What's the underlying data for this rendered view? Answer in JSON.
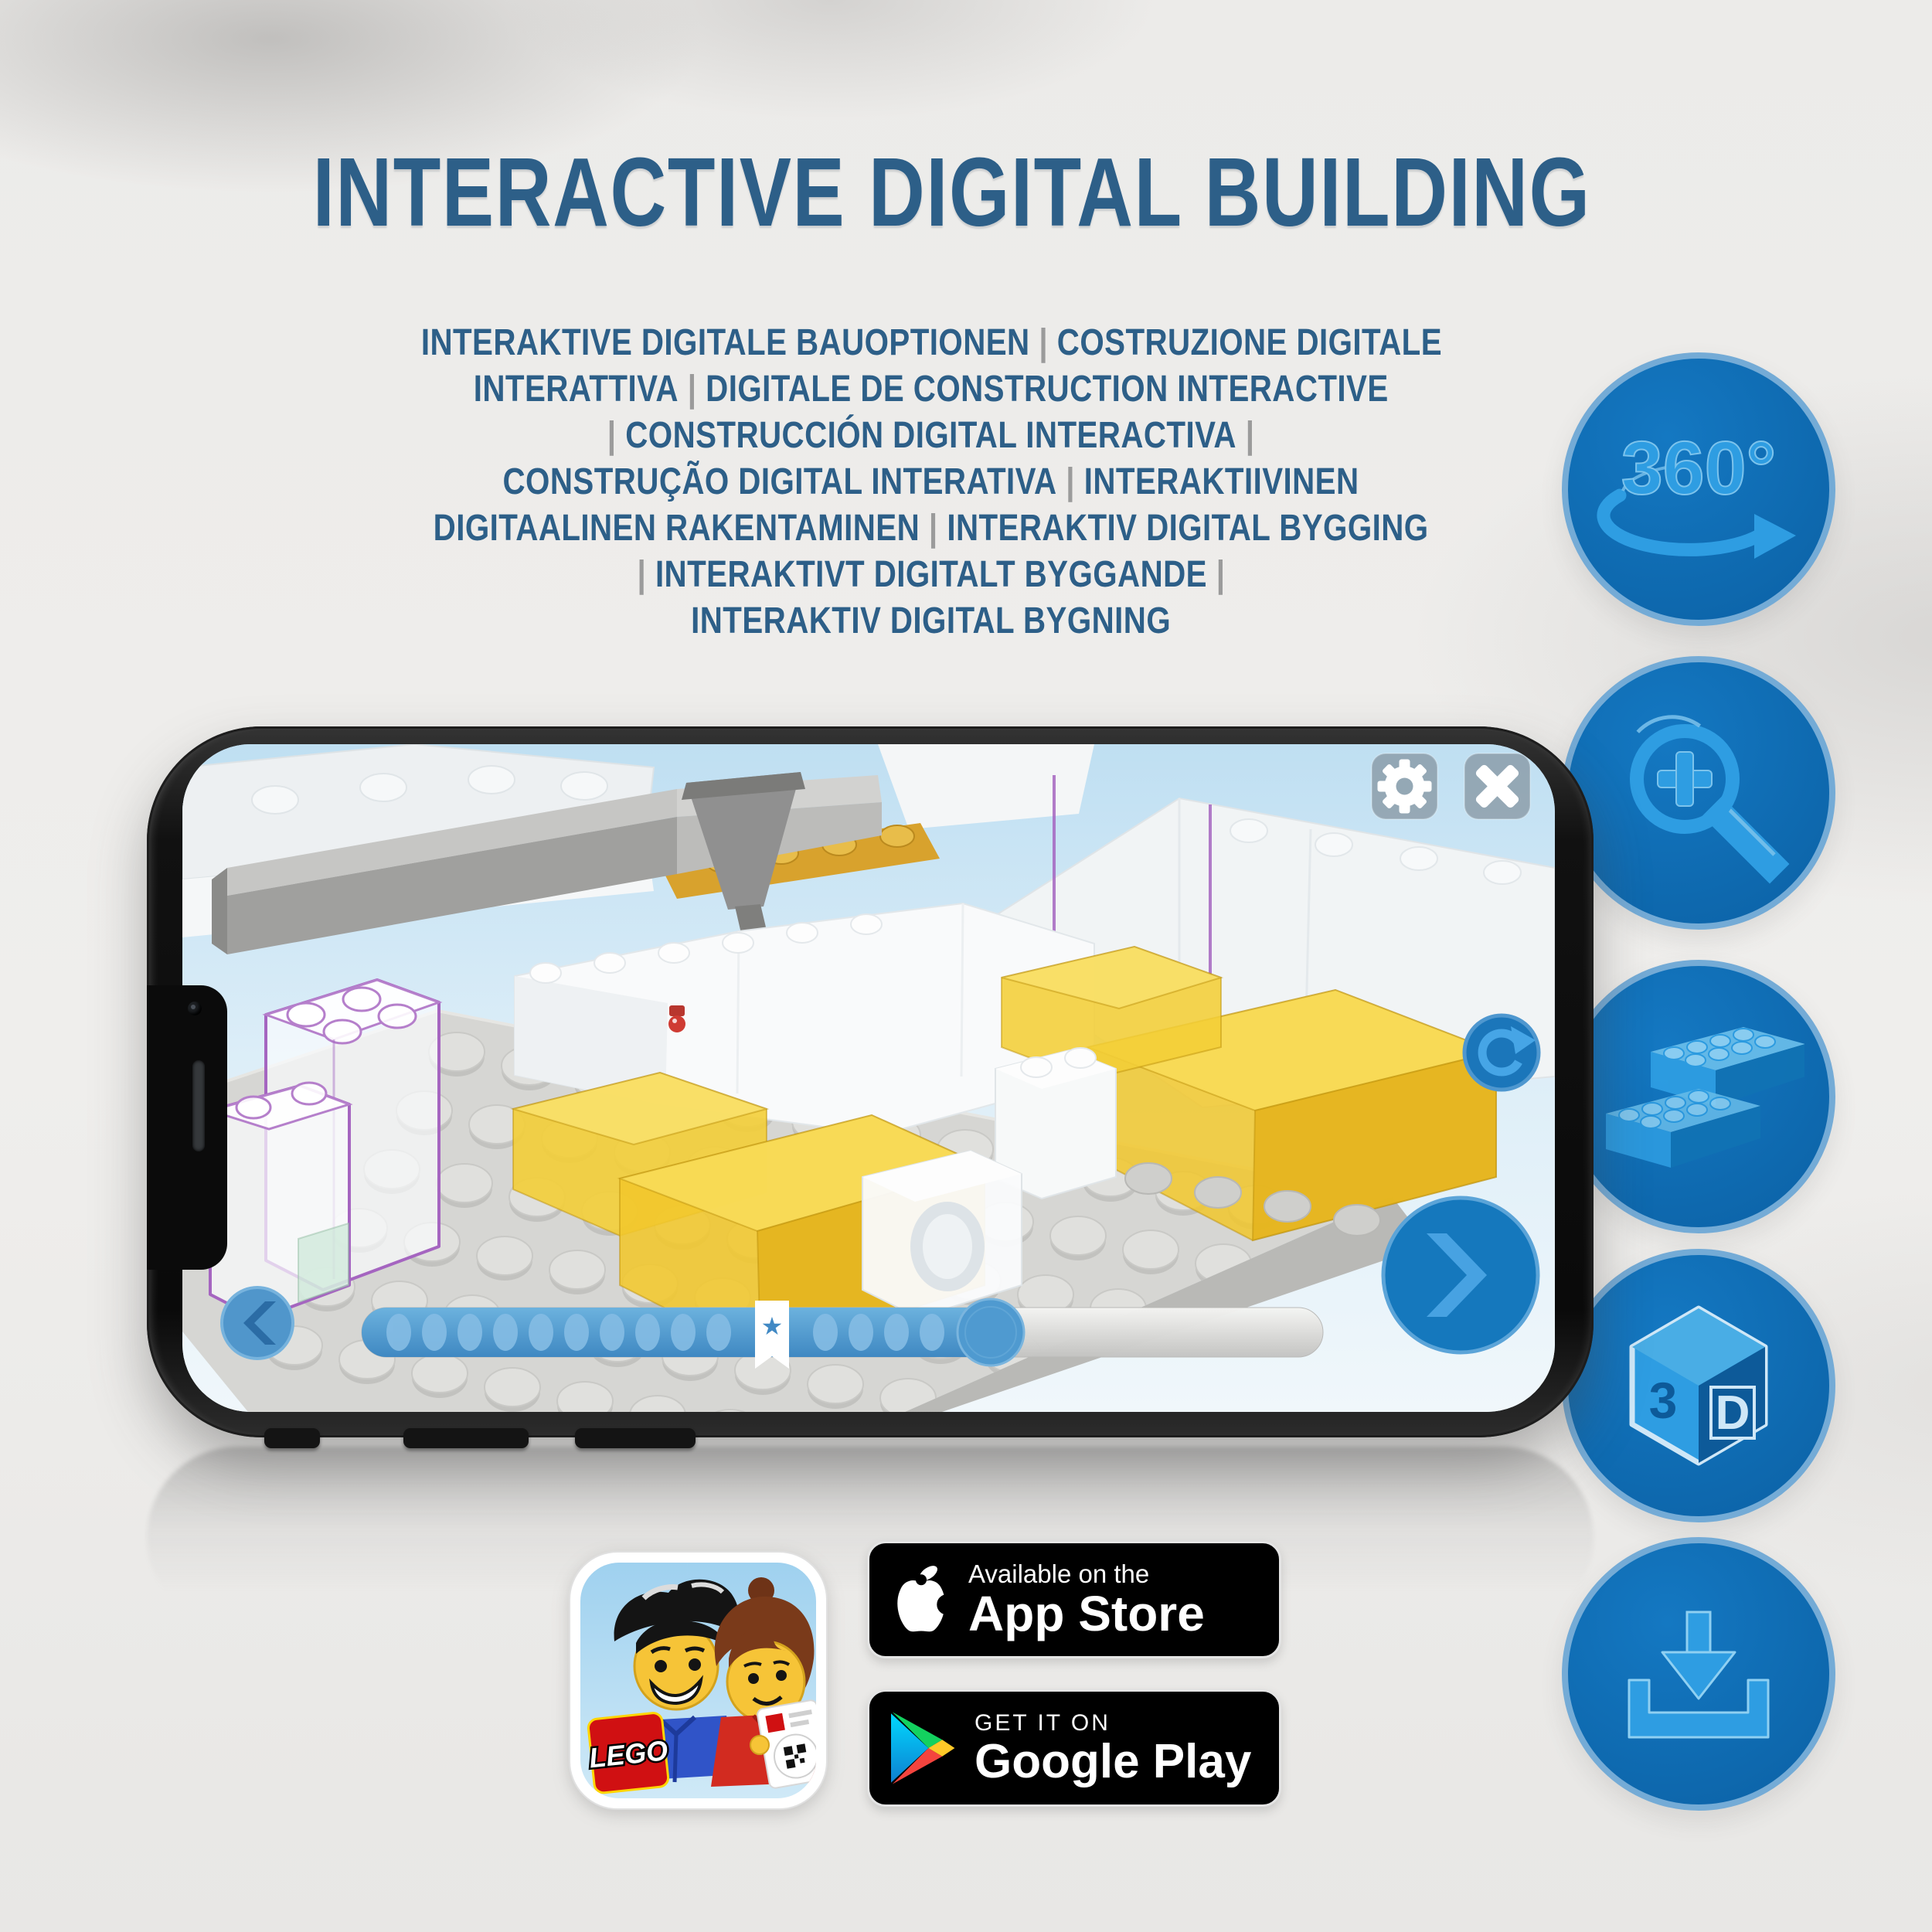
{
  "title": "INTERACTIVE DIGITAL BUILDING",
  "subtitle_lines": [
    "INTERAKTIVE DIGITALE BAUOPTIONEN | COSTRUZIONE DIGITALE",
    "INTERATTIVA | DIGITALE DE CONSTRUCTION INTERACTIVE",
    "| CONSTRUCCIÓN DIGITAL INTERACTIVA |",
    "CONSTRUÇÃO DIGITAL INTERATIVA | INTERAKTIIVINEN",
    "DIGITAALINEN RAKENTAMINEN | INTERAKTIV DIGITAL BYGGING",
    "| INTERAKTIVT DIGITALT BYGGANDE |",
    "INTERAKTIV DIGITAL BYGNING"
  ],
  "feature_icons": [
    {
      "name": "rotate-360-icon",
      "label": "360°"
    },
    {
      "name": "zoom-in-icon"
    },
    {
      "name": "bricks-icon"
    },
    {
      "name": "3d-view-icon",
      "label_left": "3",
      "label_right": "D"
    },
    {
      "name": "download-icon"
    }
  ],
  "phone": {
    "app": {
      "settings_icon": "gear-icon",
      "close_icon": "x-icon",
      "rotate_icon": "refresh-arrow-icon",
      "back_icon": "chevron-left-icon",
      "next_icon": "chevron-right-icon",
      "progress": {
        "visible_dots": 14,
        "bookmark_star": "★",
        "fill_percent": 68
      }
    }
  },
  "badges": {
    "app_store": {
      "top": "Available on the",
      "bottom": "App Store"
    },
    "google_play": {
      "top": "GET IT ON",
      "bottom": "Google Play"
    }
  },
  "app_icon": {
    "logo_text": "LEGO"
  },
  "colors": {
    "title_blue": "#2d5f88",
    "pipe_gray": "#9b9b9b",
    "circle_fill": "#0e6db4",
    "circle_ring": "#74abd6",
    "icon_main": "#2e9de2",
    "icon_highlight": "#8fd0f2",
    "icon_dark": "#0d5a99",
    "app_ui_blue": "#4f9ad0",
    "bed_yellow": "#f1c72c",
    "ghost_purple": "#a565c0"
  }
}
